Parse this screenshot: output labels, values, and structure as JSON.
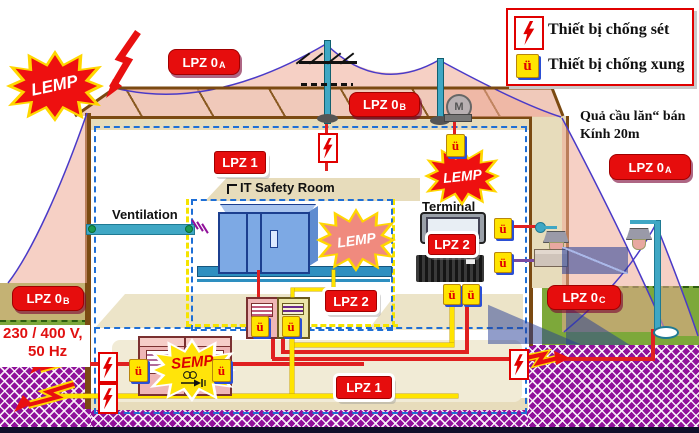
{
  "legend": {
    "items": [
      {
        "icon": "lightning-arrester",
        "label": "Thiết bị chống sét"
      },
      {
        "icon": "surge-arrester",
        "label": "Thiết bị chống xung"
      }
    ]
  },
  "stars": {
    "lemp": "LEMP",
    "semp": "SEMP"
  },
  "zones": {
    "lpz0": "LPZ 0",
    "sub_a": "A",
    "sub_b": "B",
    "sub_c": "C",
    "lpz1": "LPZ 1",
    "lpz2": "LPZ 2"
  },
  "texts": {
    "ventilation": "Ventilation",
    "it_room": "IT Safety Room",
    "terminal": "Terminal",
    "sphere_line1": "Quả cầu lăn“ bán",
    "sphere_line2": "Kính 20m",
    "volt_line1": "230 / 400 V,",
    "volt_line2": "50 Hz",
    "motor": "M",
    "surge_mark": "ü"
  },
  "colors": {
    "zone_red": "#e60d0d",
    "surge_yellow": "#ffe400",
    "ground_purple": "#90109a",
    "wire_red": "#e02020",
    "wire_yellow": "#ffe400",
    "sphere_blue": "#4a3ac8",
    "grass_green": "#7da83a",
    "roof_pink": "#f0c9ba"
  }
}
